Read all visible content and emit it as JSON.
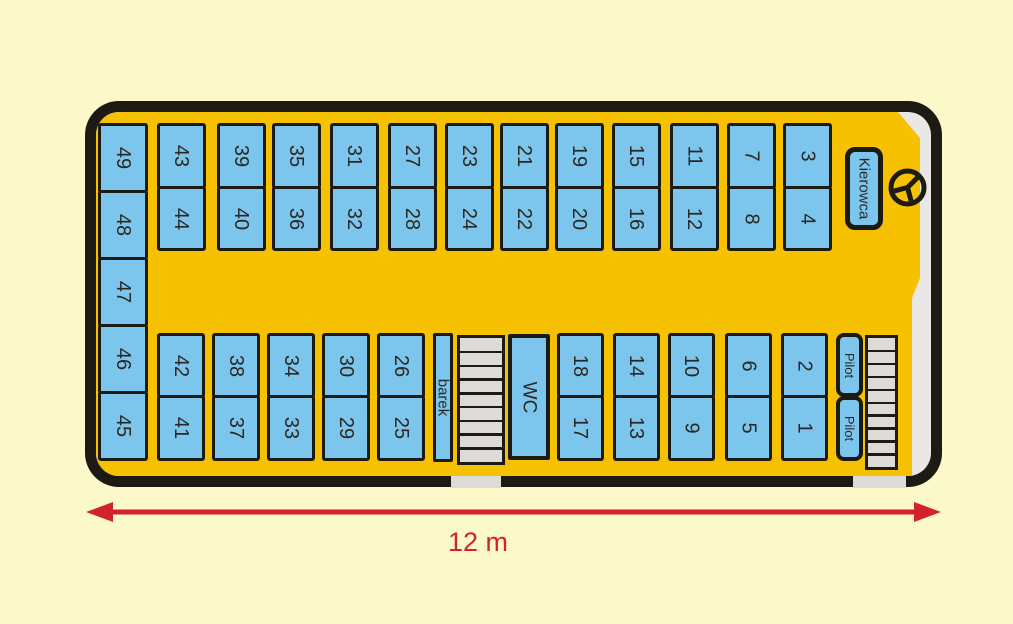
{
  "diagram": {
    "type": "bus-seating-plan",
    "bus": {
      "driver_seat": {
        "label": "Kierowca",
        "icon": "steering-wheel-icon"
      },
      "pilot_seats": [
        "Pilot",
        "Pilot"
      ],
      "wc_label": "WC",
      "bar_label": "barek",
      "back_row_seats": [
        "49",
        "48",
        "47",
        "46",
        "45"
      ],
      "top_columns": [
        [
          "43",
          "44"
        ],
        [
          "39",
          "40"
        ],
        [
          "35",
          "36"
        ],
        [
          "31",
          "32"
        ],
        [
          "27",
          "28"
        ],
        [
          "23",
          "24"
        ],
        [
          "21",
          "22"
        ],
        [
          "19",
          "20"
        ],
        [
          "15",
          "16"
        ],
        [
          "11",
          "12"
        ],
        [
          "7",
          "8"
        ],
        [
          "3",
          "4"
        ]
      ],
      "bottom_rear_columns": [
        [
          "42",
          "41"
        ],
        [
          "38",
          "37"
        ],
        [
          "34",
          "33"
        ],
        [
          "30",
          "29"
        ],
        [
          "26",
          "25"
        ]
      ],
      "bottom_front_columns": [
        [
          "18",
          "17"
        ],
        [
          "14",
          "13"
        ],
        [
          "10",
          "9"
        ],
        [
          "6",
          "5"
        ],
        [
          "2",
          "1"
        ]
      ]
    },
    "dimension_label": "12 m",
    "colors": {
      "background": "#FBF9C9",
      "floor": "#F6C100",
      "seat": "#7CC5EC",
      "outline": "#1D1A14",
      "windshield": "#E9E8E4",
      "steps": "#DCDBD7",
      "arrow": "#D2232A"
    }
  }
}
